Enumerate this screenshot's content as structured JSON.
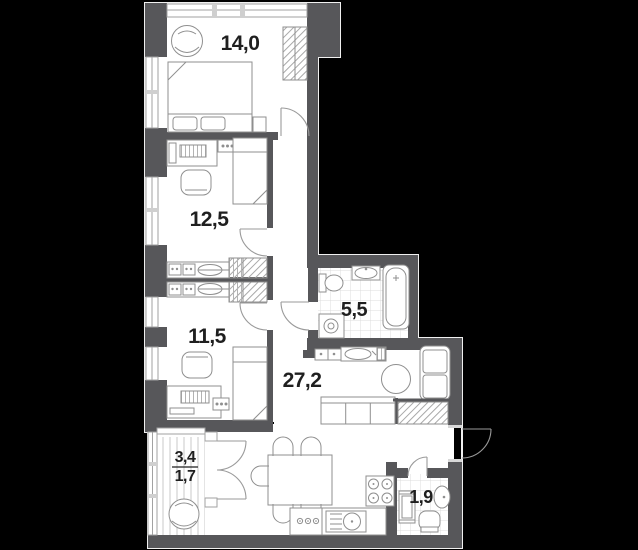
{
  "plan": {
    "background_color": "#000000",
    "wall_color": "#57575a",
    "floor_color": "#ffffff",
    "outline_color": "#f0f0f0",
    "rooms": [
      {
        "name": "bedroom-top",
        "area_label": "14,0"
      },
      {
        "name": "bedroom-middle",
        "area_label": "12,5"
      },
      {
        "name": "bedroom-lower",
        "area_label": "11,5"
      },
      {
        "name": "bathroom",
        "area_label": "5,5"
      },
      {
        "name": "living-kitchen-hall",
        "area_label": "27,2"
      },
      {
        "name": "wc",
        "area_label": "1,9"
      },
      {
        "name": "balcony",
        "area_label_total": "3,4",
        "area_label_reduced": "1,7"
      }
    ]
  }
}
